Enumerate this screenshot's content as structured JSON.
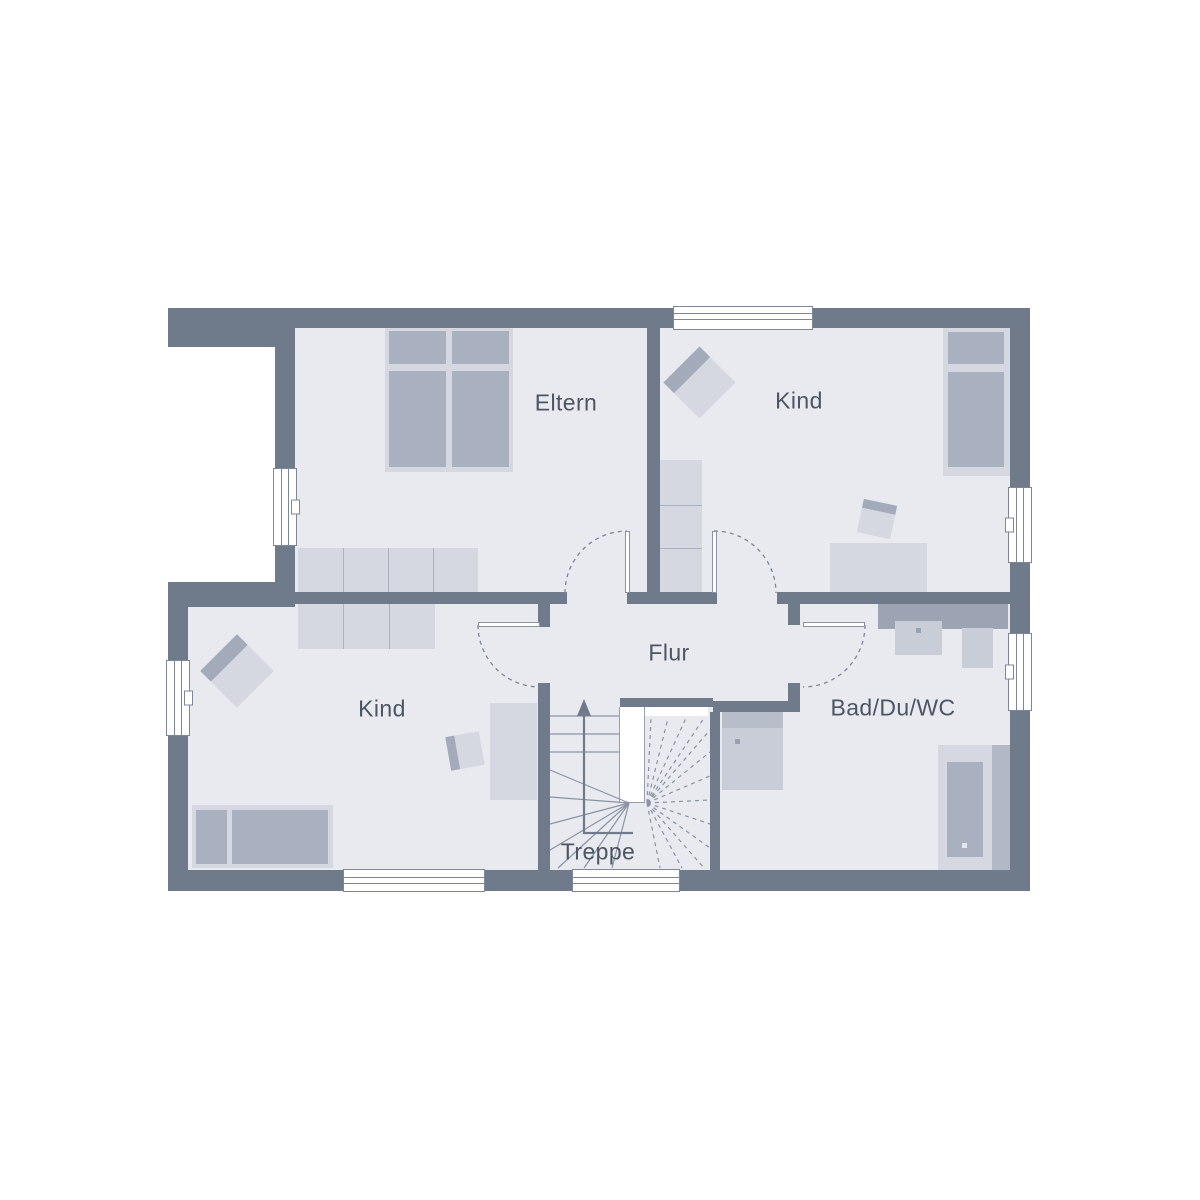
{
  "plan": {
    "type": "floor-plan",
    "rooms": {
      "eltern": {
        "label": "Eltern"
      },
      "kind_top": {
        "label": "Kind"
      },
      "kind_bottom": {
        "label": "Kind"
      },
      "flur": {
        "label": "Flur"
      },
      "bad": {
        "label": "Bad/Du/WC"
      },
      "treppe": {
        "label": "Treppe"
      }
    },
    "colors": {
      "wall": "#6f7a8a",
      "floor": "#e8eaf0",
      "background": "#ffffff",
      "furniture_light": "#d5d8e1",
      "furniture_medium": "#a9b0bf",
      "fixture_light": "#c9cdd8",
      "counter": "#9ca4b4",
      "line": "#7d8798",
      "label_text": "#4d5464"
    }
  }
}
